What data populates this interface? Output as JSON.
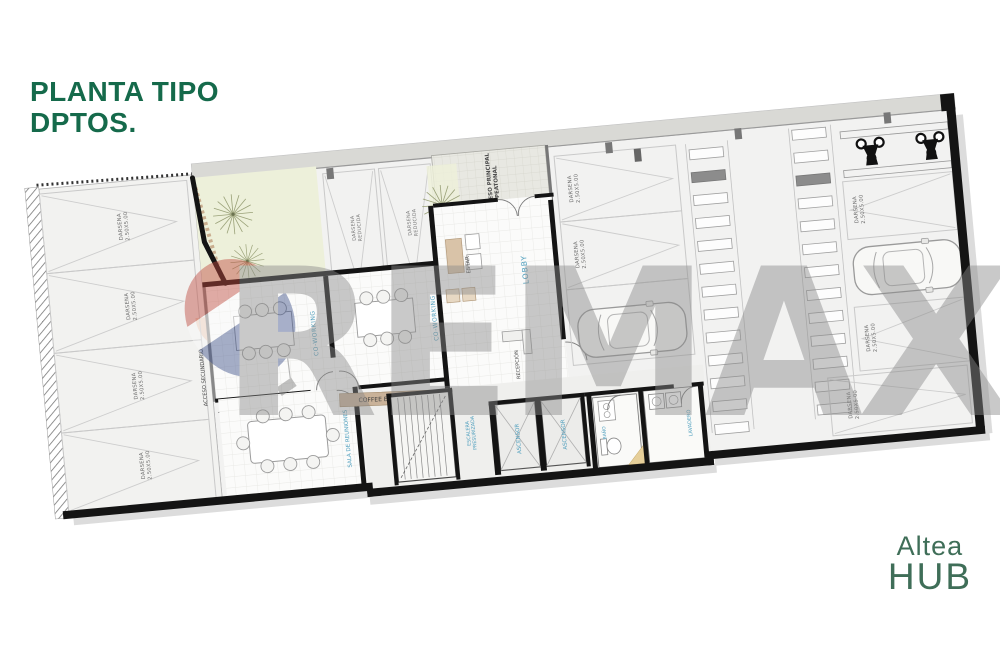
{
  "title": {
    "line1": "PLANTA TIPO",
    "line2": "DPTOS."
  },
  "brand": {
    "line1": "Altea",
    "line2": "HUB"
  },
  "watermark": {
    "text": "REMAX"
  },
  "colors": {
    "title-green": "#156a4b",
    "brand-green": "#3f6e58",
    "label-blue": "#4f9fbe",
    "label-dark": "#4a4a4a",
    "wall-black": "#141414",
    "banner-tan": "#c9b299",
    "garden-green": "#edf0da",
    "entry-peach": "#eac9b6",
    "watermark-gray": "#8a8a8a",
    "balloon-red": "#bf4a3e",
    "balloon-blue": "#3d5089"
  },
  "plan": {
    "rooms": {
      "coworking": "CO-WORKING",
      "lobby": "LOBBY",
      "estar": "ESTAR",
      "recepcion": "RECEPCIÓN",
      "sala_reuniones": "SALA DE REUNIONES",
      "coffee_express": "COFFEE EXPRESS",
      "escalera": {
        "line1": "ESCALERA",
        "line2": "PRESURIZADA"
      },
      "ascensor": "ASCENSOR",
      "bano": "BAÑO",
      "lavadero": "LAVADERO",
      "acceso_principal": {
        "line1": "ACCESO PRINCIPAL",
        "line2": "PEATONAL"
      },
      "acceso_secundario": "ACCESO SECUNDARIO"
    },
    "parking": {
      "darsena": {
        "line1": "DARSENA",
        "line2": "2.50X5.00"
      },
      "darsena_reducida": {
        "line1": "DARSENA",
        "line2": "REDUCIDA"
      }
    }
  }
}
